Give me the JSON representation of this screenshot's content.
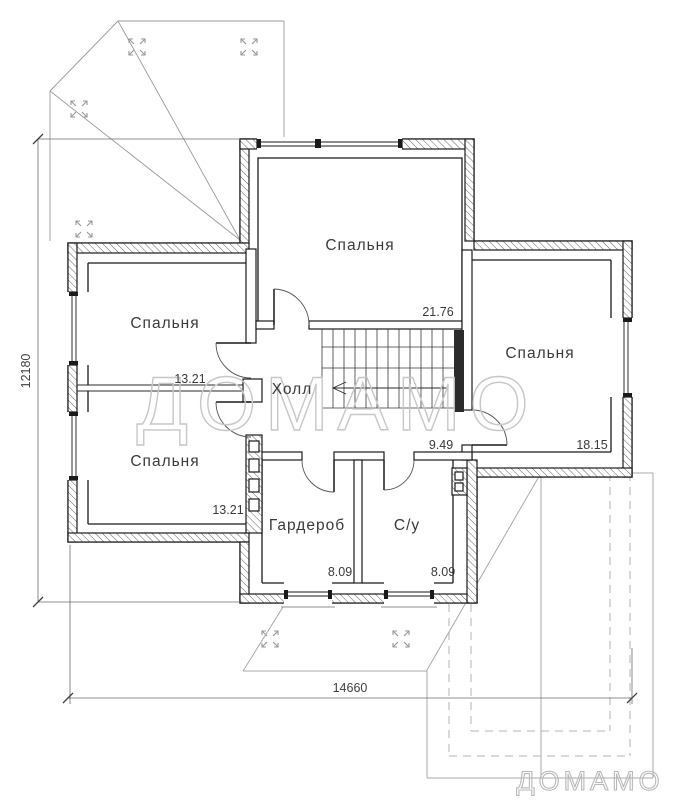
{
  "floor_plan": {
    "rooms": {
      "bedroom_top": {
        "name": "Спальня",
        "area": "21.76"
      },
      "bedroom_left_top": {
        "name": "Спальня",
        "area": "13.21"
      },
      "bedroom_left_bottom": {
        "name": "Спальня",
        "area": "13.21"
      },
      "bedroom_right": {
        "name": "Спальня",
        "area": "18.15"
      },
      "hall": {
        "name": "Холл",
        "area": "9.49"
      },
      "wardrobe": {
        "name": "Гардероб",
        "area": "8.09"
      },
      "bathroom": {
        "name": "С/у",
        "area": "8.09"
      }
    },
    "dimensions": {
      "overall_width_mm": "14660",
      "overall_height_mm": "12180"
    },
    "watermark": {
      "center": "ДОМАМО",
      "corner": "ДОМАМО"
    },
    "icons": {
      "roof_slope": "expand-arrows-icon"
    },
    "colors": {
      "wall_line": "#1a1a1a",
      "overlay_gray": "#a9a9a9",
      "watermark_gray": "#c7c7c7"
    }
  }
}
